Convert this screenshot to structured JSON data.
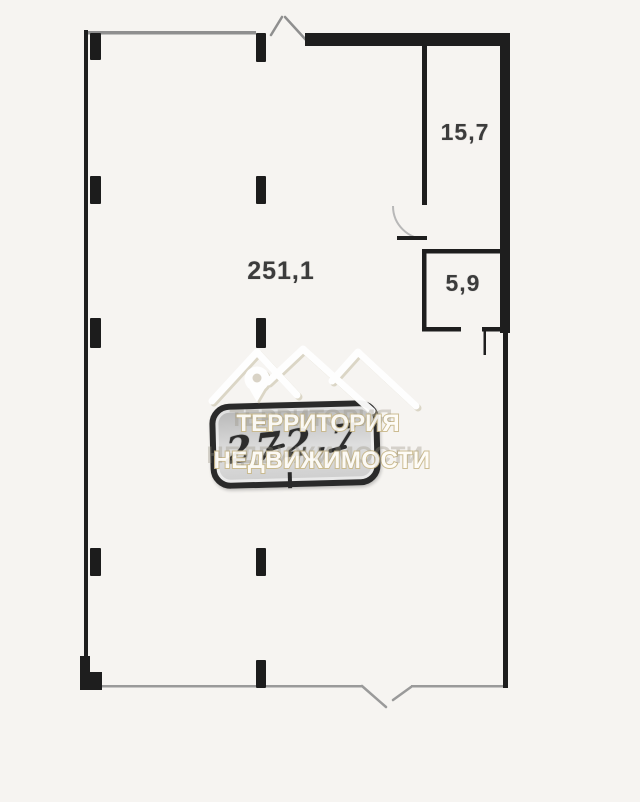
{
  "colors": {
    "background": "#f6f4f1",
    "wall": "#1e1e1e",
    "thin_line": "#9a9a9a",
    "label_text": "#3c3c3c",
    "watermark_outline": "#c9b88a",
    "badge_fill": "#d4d4d4"
  },
  "floor_plan": {
    "rooms": [
      {
        "name": "main room",
        "area": "251,1"
      },
      {
        "name": "top right room",
        "area": "15,7"
      },
      {
        "name": "small room",
        "area": "5,9"
      }
    ],
    "total_area_badge": "272,7"
  },
  "watermark": {
    "logo_icon": "mountains-location-pin-icon",
    "line1": "ТЕРРИТОРИЯ",
    "line2": "НЕДВИЖИМОСТИ"
  }
}
